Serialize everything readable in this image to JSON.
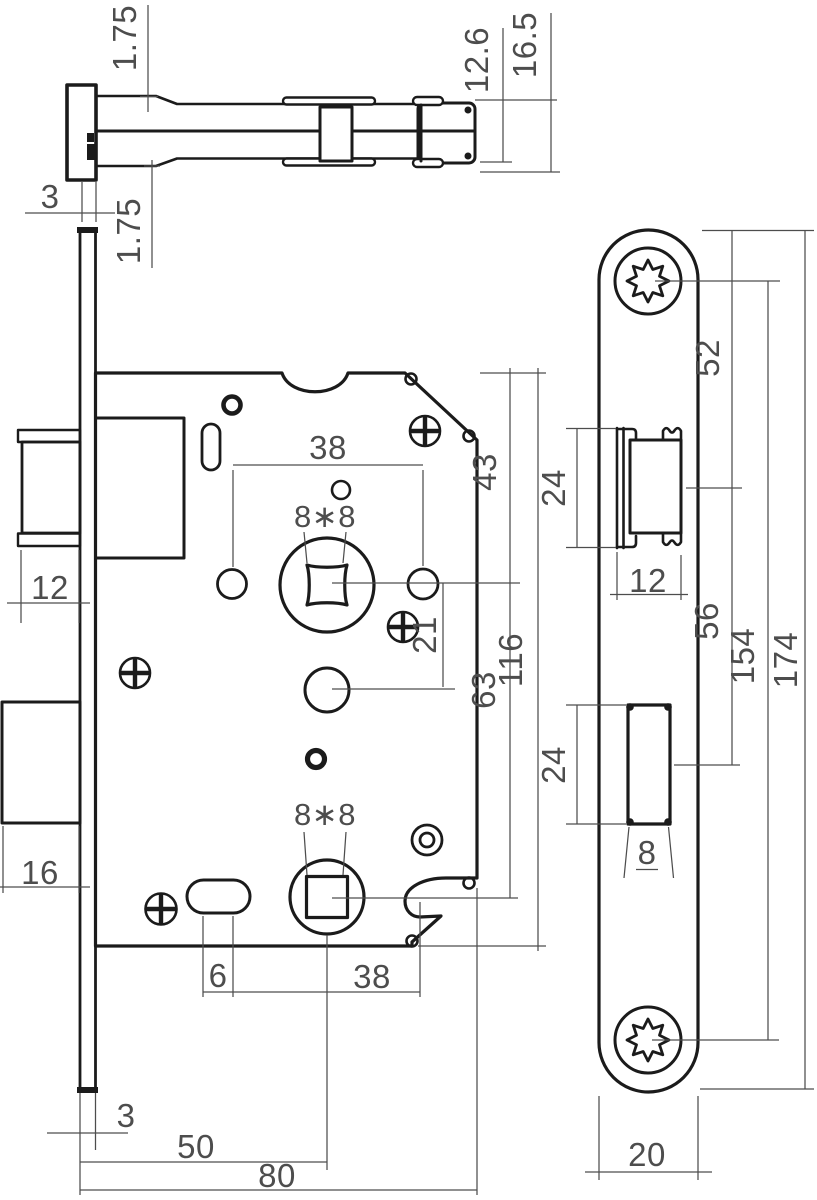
{
  "drawing": {
    "type": "technical-drawing",
    "subject": "Mortise door lock - dimensioned orthographic views",
    "colors": {
      "line": "#1b1b1b",
      "dim": "#4d4d4d",
      "bg": "#ffffff"
    },
    "views": {
      "top_section": {
        "label": "top section view",
        "dims": {
          "plate_upper": "1.75",
          "inner_height": "12.6",
          "outer_height": "16.5",
          "faceplate_thickness": "3",
          "plate_lower": "1.75"
        }
      },
      "front": {
        "label": "front view",
        "dims": {
          "hub_hole_span": "38",
          "top_to_hub": "43",
          "hub_square": "8∗8",
          "latch_throw": "12",
          "hub_to_cylinder": "21",
          "case_height": "116",
          "hub_to_hub": "63",
          "bolt_throw": "16",
          "lower_square": "8∗8",
          "slot_width": "6",
          "slot_to_edge": "38",
          "plate_thickness": "3",
          "backset": "50",
          "case_depth": "80"
        }
      },
      "faceplate": {
        "label": "faceplate view",
        "dims": {
          "top_to_latch": "52",
          "latch_cutout_height": "24",
          "latch_cutout_width": "12",
          "latch_to_bolt": "56",
          "screw_centers": "154",
          "plate_height": "174",
          "bolt_cutout_height": "24",
          "bolt_cutout_width": "8",
          "plate_width": "20"
        }
      }
    }
  }
}
